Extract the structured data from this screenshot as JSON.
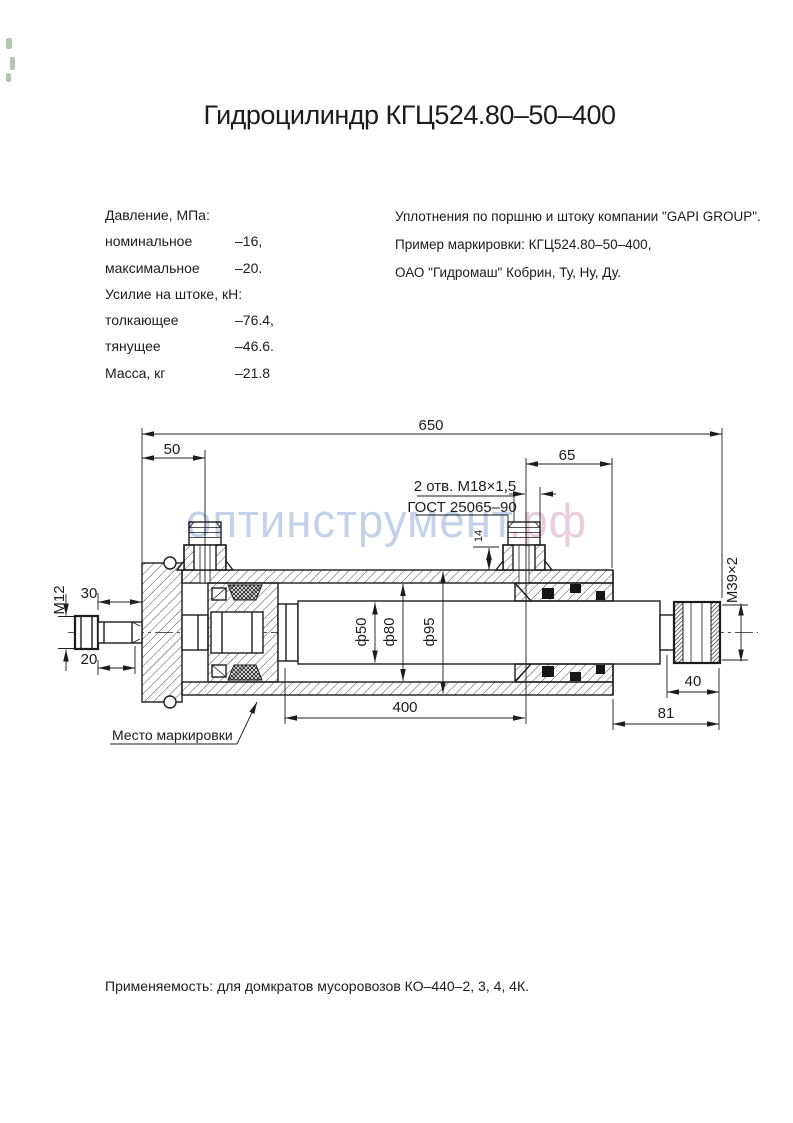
{
  "title": "Гидроцилиндр КГЦ524.80–50–400",
  "specs": {
    "rows": [
      {
        "label": "Давление, МПа:",
        "value": ""
      },
      {
        "label": "номинальное",
        "value": "–16,"
      },
      {
        "label": "максимальное",
        "value": "–20."
      },
      {
        "label": "Усилие на штоке, кН:",
        "value": ""
      },
      {
        "label": "толкающее",
        "value": "–76.4,"
      },
      {
        "label": "тянущее",
        "value": "–46.6."
      },
      {
        "label": "Масса, кг",
        "value": "–21.8"
      }
    ]
  },
  "notes": {
    "lines": [
      "Уплотнения по поршню и штоку компании \"GAPI GROUP\".",
      "Пример маркировки: КГЦ524.80–50–400,",
      "ОАО \"Гидромаш\" Кобрин, Ту, Ну, Ду."
    ]
  },
  "watermark": {
    "part1": "оптинструмент",
    "part2": ".рф",
    "color1": "#bccbe8",
    "color2": "#e9c5d7"
  },
  "drawing": {
    "dims": {
      "overall": "650",
      "port_offset": "50",
      "port_to_end": "65",
      "ports_line1": "2 отв. М18×1,5",
      "ports_line2": "ГОСТ 25065–90",
      "boss_height": "14",
      "stud_thread": "М12",
      "stud_len_top": "30",
      "stud_len_bottom": "20",
      "rod_diameter": "ф50",
      "bore_diameter": "ф80",
      "outer_diameter": "ф95",
      "stroke_length": "400",
      "thread_length": "40",
      "rod_end_length": "81",
      "rod_thread": "М39×2",
      "marking_note": "Место маркировки"
    }
  },
  "footer": "Применяемость: для домкратов мусоровозов КО–440–2, 3, 4, 4К.",
  "artifact_color": "#85ae7f"
}
